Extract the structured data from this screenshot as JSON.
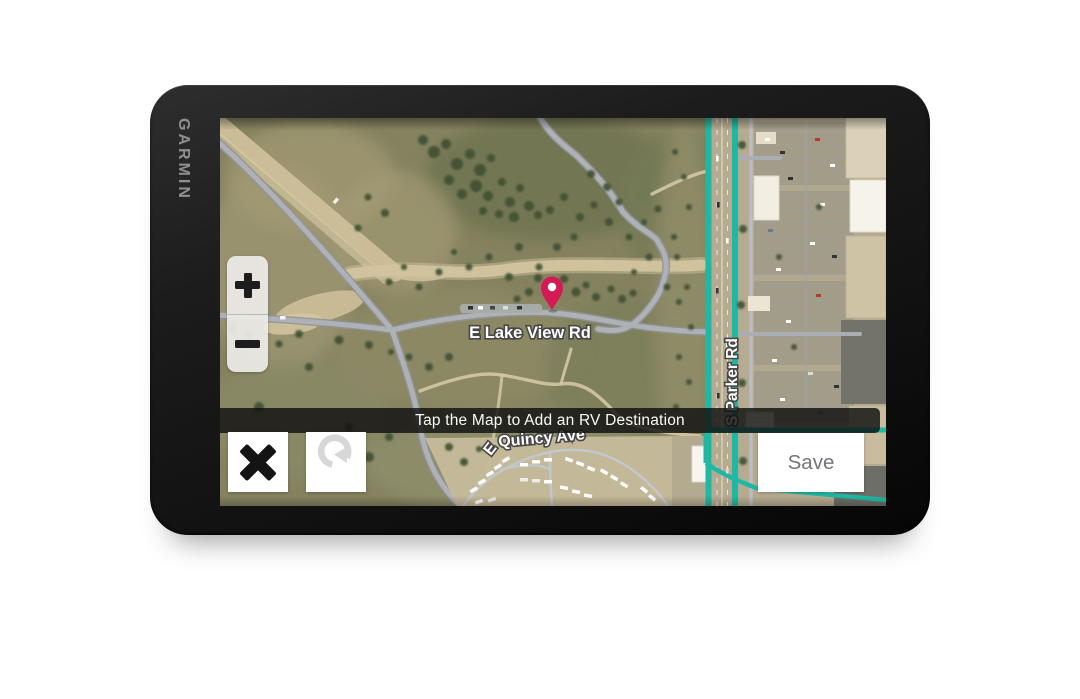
{
  "device": {
    "brand": "GARMIN"
  },
  "banner": {
    "text": "Tap the Map to Add an RV Destination"
  },
  "map": {
    "view": "satellite",
    "street_labels": {
      "lake_view_rd": "E Lake View Rd",
      "quincy_prefix": "E",
      "quincy_ave": "Quincy Ave",
      "parker_rd": "S Parker Rd"
    },
    "pin_color": "#d41a55",
    "route_highlight_color": "#1fb8a3"
  },
  "controls": {
    "zoom_in_icon": "plus",
    "zoom_out_icon": "minus",
    "close_icon": "x-cross",
    "undo_icon": "rotate-ccw-arrow",
    "save_label": "Save",
    "zoom_in_aria": "Zoom in",
    "zoom_out_aria": "Zoom out",
    "close_aria": "x-cross",
    "undo_aria": "rotate-ccw-arrow"
  }
}
